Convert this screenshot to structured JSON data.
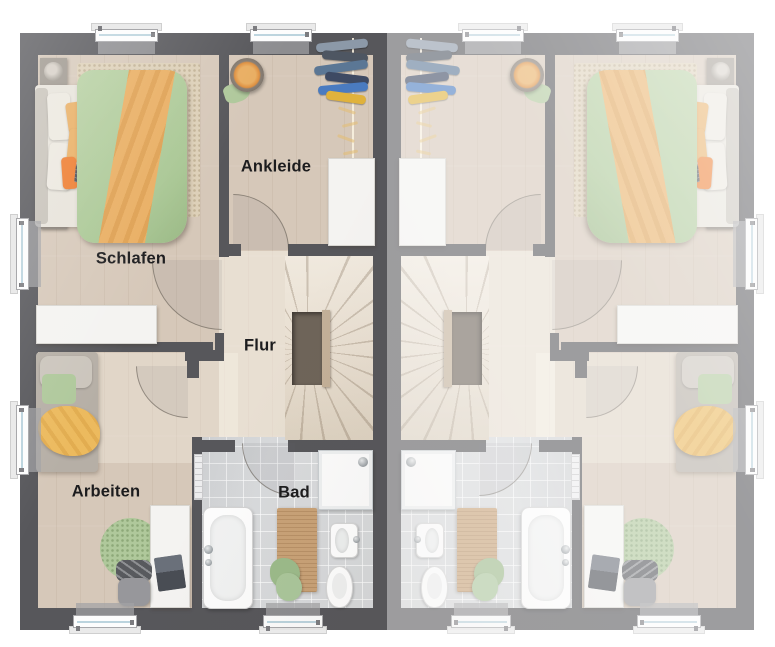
{
  "floorplan": {
    "rooms": {
      "schlafen": "Schlafen",
      "ankleide": "Ankleide",
      "flur": "Flur",
      "arbeiten": "Arbeiten",
      "bad": "Bad"
    },
    "colors": {
      "wall": "#57575b",
      "wall_faded_reference": "#9e9ea2",
      "floor_wood": "#d6c8b9",
      "floor_bath": "#d8dadc",
      "stair_void": "#6e6459",
      "stair_rail": "#c3b098",
      "duvet_green": "#b7d0a2",
      "blanket_orange": "#e9ae62",
      "throw_orange": "#ee7c2e",
      "furniture_white": "#f4f3f1",
      "rug_green": "#afc89b",
      "rug_beige": "#ddd0b8",
      "wood_mat": "#c9a277",
      "window_glass": "#bcd4de",
      "label_text": "#1c1c1e"
    }
  }
}
